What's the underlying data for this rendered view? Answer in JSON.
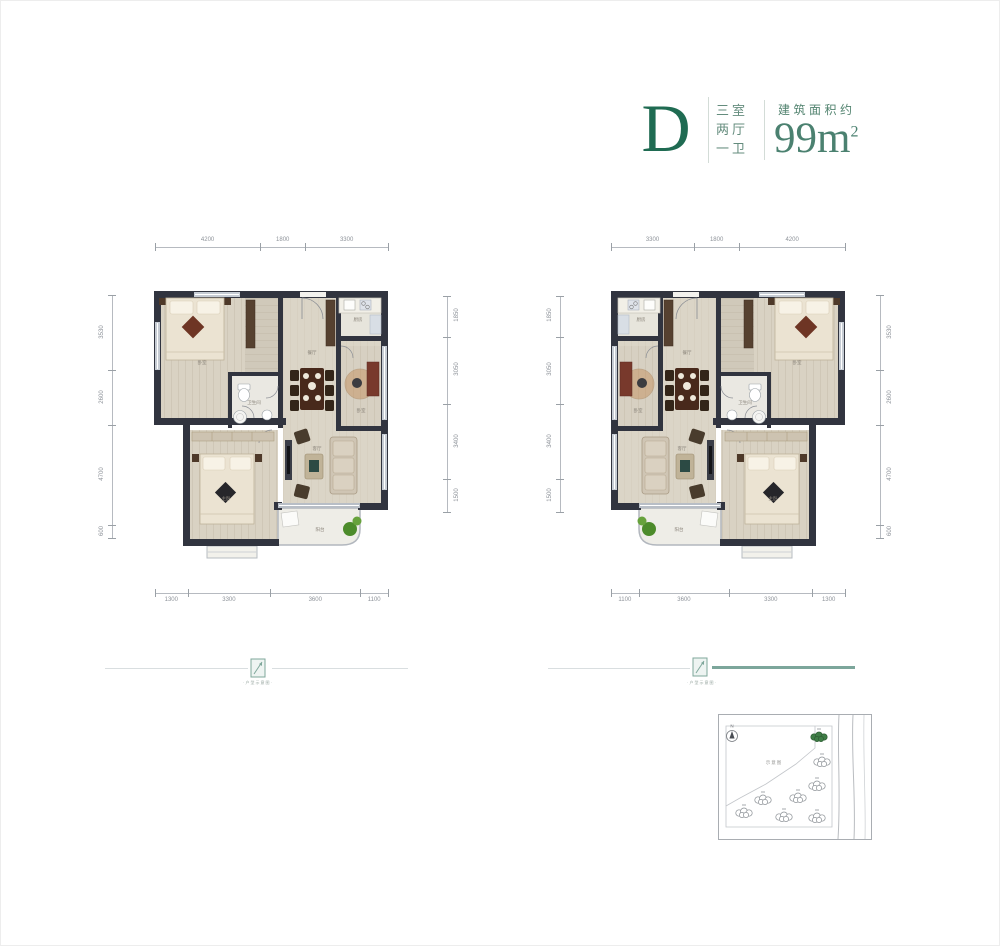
{
  "header": {
    "unit_letter": "D",
    "spec_lines": [
      "三室",
      "两厅",
      "一卫"
    ],
    "area_label": "建筑面积约",
    "area_value": "99m",
    "area_exponent": "2"
  },
  "plans": {
    "left": {
      "dims_top": [
        "4200",
        "1800",
        "3300"
      ],
      "dims_bottom": [
        "1300",
        "3300",
        "3600",
        "1100"
      ],
      "dims_left": [
        "3530",
        "2600",
        "4700",
        "600"
      ],
      "dims_right": [
        "1850",
        "3050",
        "3400",
        "1500"
      ]
    },
    "right": {
      "dims_top": [
        "3300",
        "1800",
        "4200"
      ],
      "dims_bottom": [
        "1100",
        "3600",
        "3300",
        "1300"
      ],
      "dims_left": [
        "1850",
        "3050",
        "3400",
        "1500"
      ],
      "dims_right": [
        "3530",
        "2600",
        "4700",
        "600"
      ]
    }
  },
  "rooms": [
    "卧室",
    "厨房",
    "餐厅",
    "卧室",
    "卫生间",
    "客厅",
    "主卧",
    "阳台"
  ],
  "dividers": {
    "caption": "·户型示意图·"
  },
  "site_map": {
    "label": "示意图",
    "north_label": "N",
    "buildings": [
      {
        "x": 101,
        "y": 23,
        "highlighted": true
      },
      {
        "x": 104,
        "y": 48,
        "highlighted": false
      },
      {
        "x": 99,
        "y": 72,
        "highlighted": false
      },
      {
        "x": 80,
        "y": 84,
        "highlighted": false
      },
      {
        "x": 45,
        "y": 86,
        "highlighted": false
      },
      {
        "x": 26,
        "y": 99,
        "highlighted": false
      },
      {
        "x": 66,
        "y": 103,
        "highlighted": false
      },
      {
        "x": 99,
        "y": 104,
        "highlighted": false
      }
    ]
  },
  "colors": {
    "accent_green": "#1f6b52",
    "area_green": "#4b8170",
    "wall": "#31343f",
    "floor": "#d9d2c3",
    "window": "#c6ccd4",
    "highlight_building": "#3f7d46",
    "plant_green": "#4c8b2b"
  }
}
